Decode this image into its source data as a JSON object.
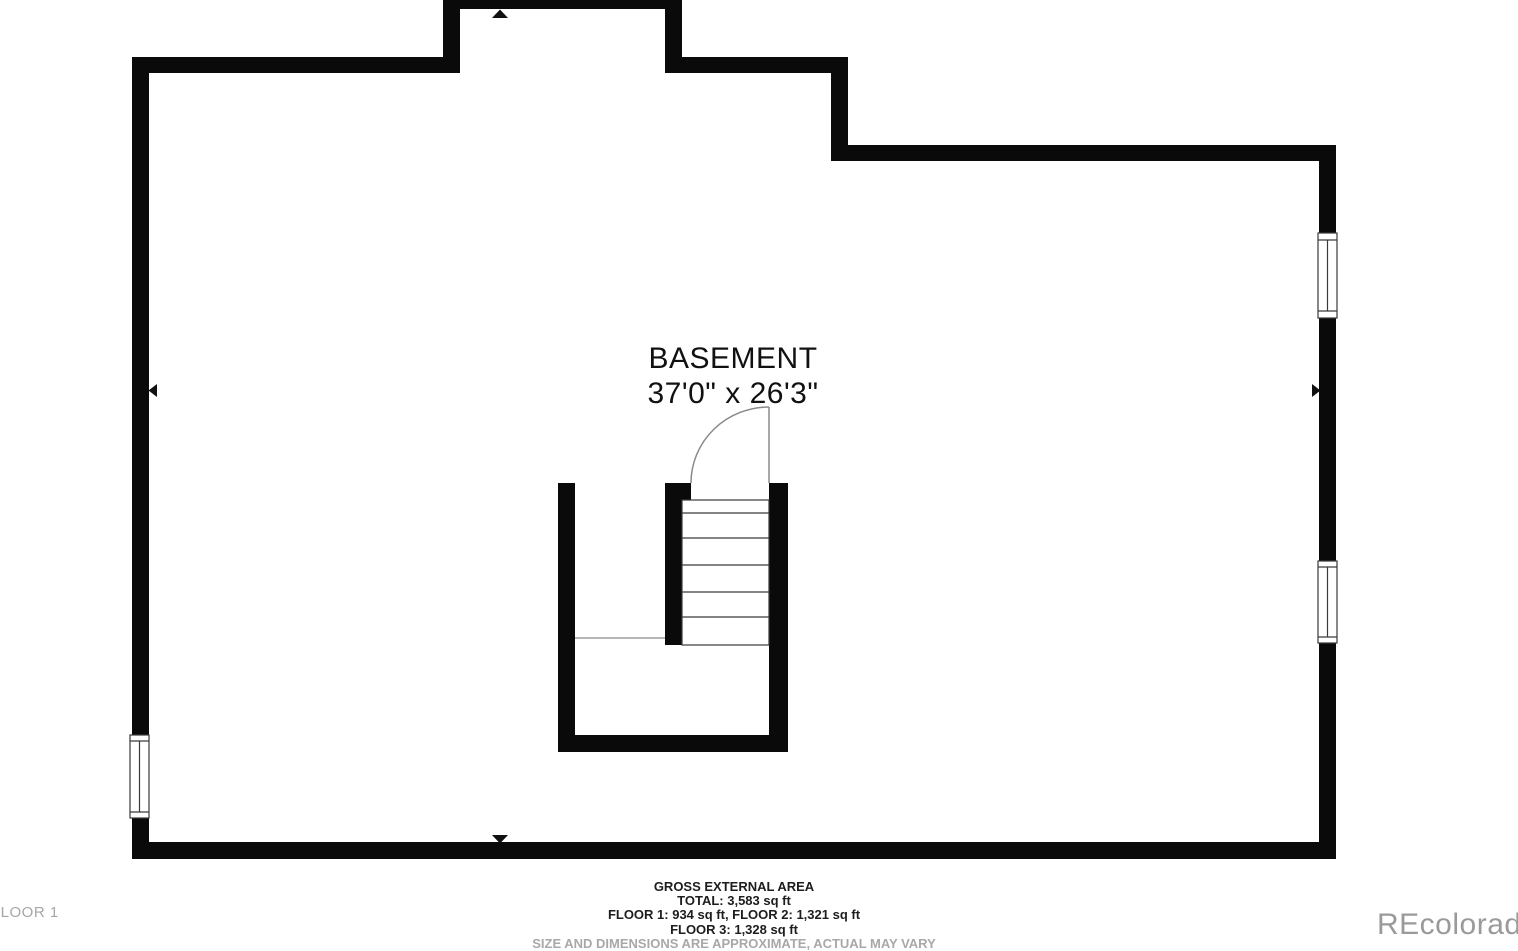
{
  "room": {
    "name": "BASEMENT",
    "dimensions": "37'0\" x 26'3\""
  },
  "footer": {
    "lines": [
      "GROSS EXTERNAL AREA",
      "TOTAL: 3,583 sq ft",
      "FLOOR 1: 934 sq ft, FLOOR 2: 1,321 sq ft",
      "FLOOR 3: 1,328 sq ft",
      "SIZE AND DIMENSIONS ARE APPROXIMATE, ACTUAL MAY VARY"
    ]
  },
  "watermarks": {
    "floor_label": "FLOOR 1",
    "brand": "REcolorado"
  },
  "icons": {
    "markers": [
      "arrow-up-marker",
      "arrow-left-marker",
      "arrow-right-marker",
      "arrow-down-marker"
    ]
  },
  "colors": {
    "background": "#ffffff",
    "wall": "#0a0a0a",
    "thin_line": "#3a3a3a",
    "door_line": "#8a8a8a",
    "watermark_gray": "#9e9e9e"
  }
}
